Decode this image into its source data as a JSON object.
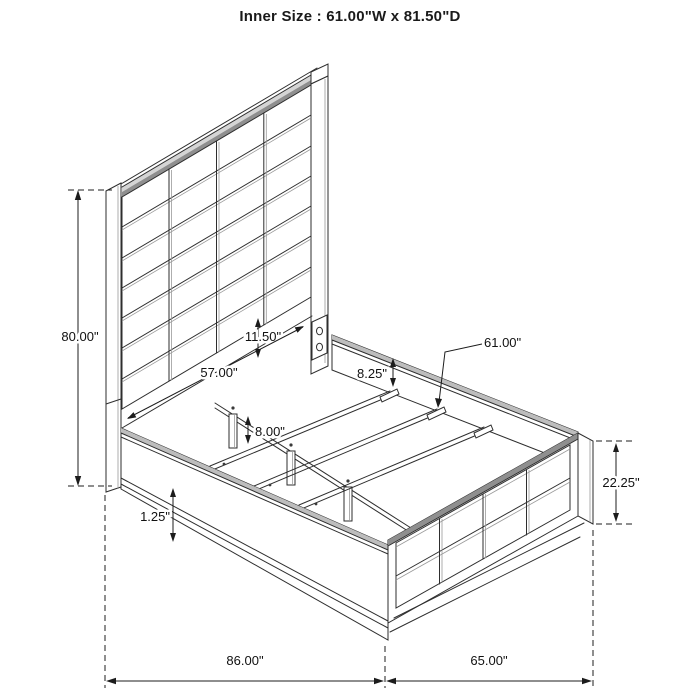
{
  "title": "Inner Size : 61.00\"W x 81.50\"D",
  "dims": {
    "headboard_height": "80.00\"",
    "headboard_base_height": "11.50\"",
    "headboard_inner_width": "57.00\"",
    "side_rail_depth": "8.25\"",
    "slat_length": "61.00\"",
    "center_leg_height": "8.00\"",
    "base_trim_height": "1.25\"",
    "footboard_height": "22.25\"",
    "overall_length": "86.00\"",
    "overall_width": "65.00\""
  },
  "colors": {
    "line": "#2e2e2e",
    "shade_dark": "#8f8f8f",
    "shade_light": "#d5d5d5",
    "background": "#ffffff"
  }
}
